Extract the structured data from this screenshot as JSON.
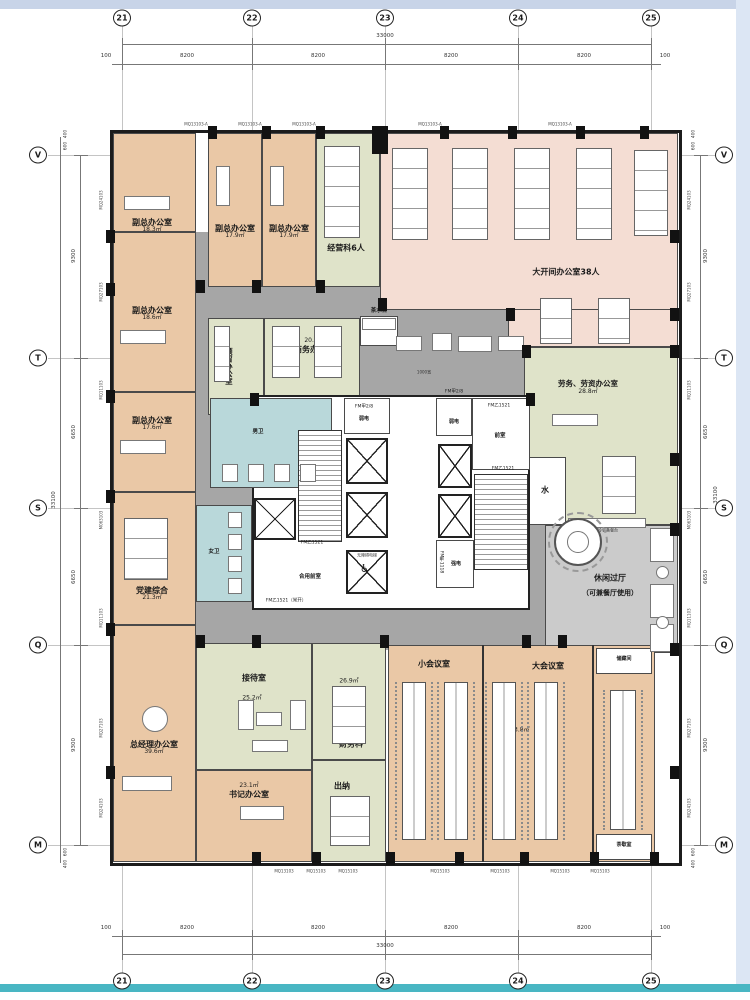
{
  "grid": {
    "top_axes": [
      "21",
      "22",
      "23",
      "24",
      "25"
    ],
    "bottom_axes": [
      "21",
      "22",
      "23",
      "24",
      "25"
    ],
    "left_axes": [
      "V",
      "T",
      "S",
      "Q",
      "M"
    ],
    "right_axes": [
      "V",
      "T",
      "S",
      "Q",
      "M"
    ],
    "h_total": "33000",
    "h_bay": "8200",
    "h_edge": "100",
    "v_total": "33100",
    "v_bays": [
      "9300",
      "6650",
      "6650",
      "9300"
    ],
    "v_edge_a": "400",
    "v_edge_b": "600"
  },
  "wall_labels": {
    "top": "MQ13103-A",
    "bottom_first": "MQ13103",
    "bottom": "MQ15103",
    "left": [
      "MQ24103",
      "MQ27103",
      "MQ11103",
      "M063103",
      "MQ11103",
      "MQ27103",
      "MQ24103"
    ],
    "right": [
      "MQ24103",
      "MQ27103",
      "MQ11103",
      "M063103",
      "MQ11103",
      "MQ27103",
      "MQ24103"
    ]
  },
  "rooms": {
    "vice1": {
      "name": "副总办公室",
      "area": "18.3㎡"
    },
    "vice2": {
      "name": "副总办公室",
      "area": "17.9㎡"
    },
    "vice3": {
      "name": "副总办公室",
      "area": "17.9㎡"
    },
    "vice4": {
      "name": "副总办公室",
      "area": "18.6㎡"
    },
    "vice5": {
      "name": "副总办公室",
      "area": "17.6㎡"
    },
    "operations": {
      "name": "经营科6人"
    },
    "open_office": {
      "name": "大开间办公室38人"
    },
    "reserved": {
      "name": "预留办公室"
    },
    "business": {
      "name": "商务办公室",
      "area": "20.5㎡"
    },
    "labor": {
      "name": "劳务、劳资办公室",
      "area": "28.8㎡"
    },
    "leisure": {
      "name": "休闲过厅",
      "sub": "（可兼餐厅使用）"
    },
    "party": {
      "name": "党建综合",
      "area": "21.3㎡"
    },
    "gm": {
      "name": "总经理办公室",
      "area": "39.6㎡"
    },
    "reception": {
      "name": "接待室",
      "area": "25.2㎡"
    },
    "secretary": {
      "name": "书记办公室",
      "area": "23.1㎡"
    },
    "finance": {
      "name": "财务科",
      "area": "26.9㎡"
    },
    "cashier": {
      "name": "出纳"
    },
    "small_meeting": {
      "name": "小会议室"
    },
    "large_meeting": {
      "name": "大会议室",
      "area": "103.8㎡"
    },
    "storage": {
      "name": "储藏间"
    },
    "tea_break": {
      "name": "茶歇室"
    }
  },
  "core": {
    "men_wc": "男卫",
    "women_wc": "女卫",
    "front": "前室",
    "shared_front": "合用前室",
    "weak": "弱电",
    "strong": "强电",
    "water": "水",
    "accessible_elevator": "无障碍电梯",
    "tea_station": "茶水台",
    "cold_buffet": "冷餐备餐台"
  },
  "annotations": {
    "fm_b1521": "FM乙1521",
    "fm_b1521_open": "FM乙1521（常开）",
    "fm_a28": "FM甲2/8",
    "fm_a1118": "FM甲1118",
    "corridor_width": "1000宽"
  },
  "colors": {
    "office_tan": "#eac8a6",
    "open_pink": "#f4ddd3",
    "green": "#dfe3c9",
    "toilet_blue": "#b9d8da",
    "corridor": "#a6a6a6",
    "leisure": "#cbcbcb",
    "wall": "#1c1c1c",
    "band_top": "#c8d4e8",
    "band_right": "#dce6f4",
    "band_bottom": "#49b6c3"
  }
}
